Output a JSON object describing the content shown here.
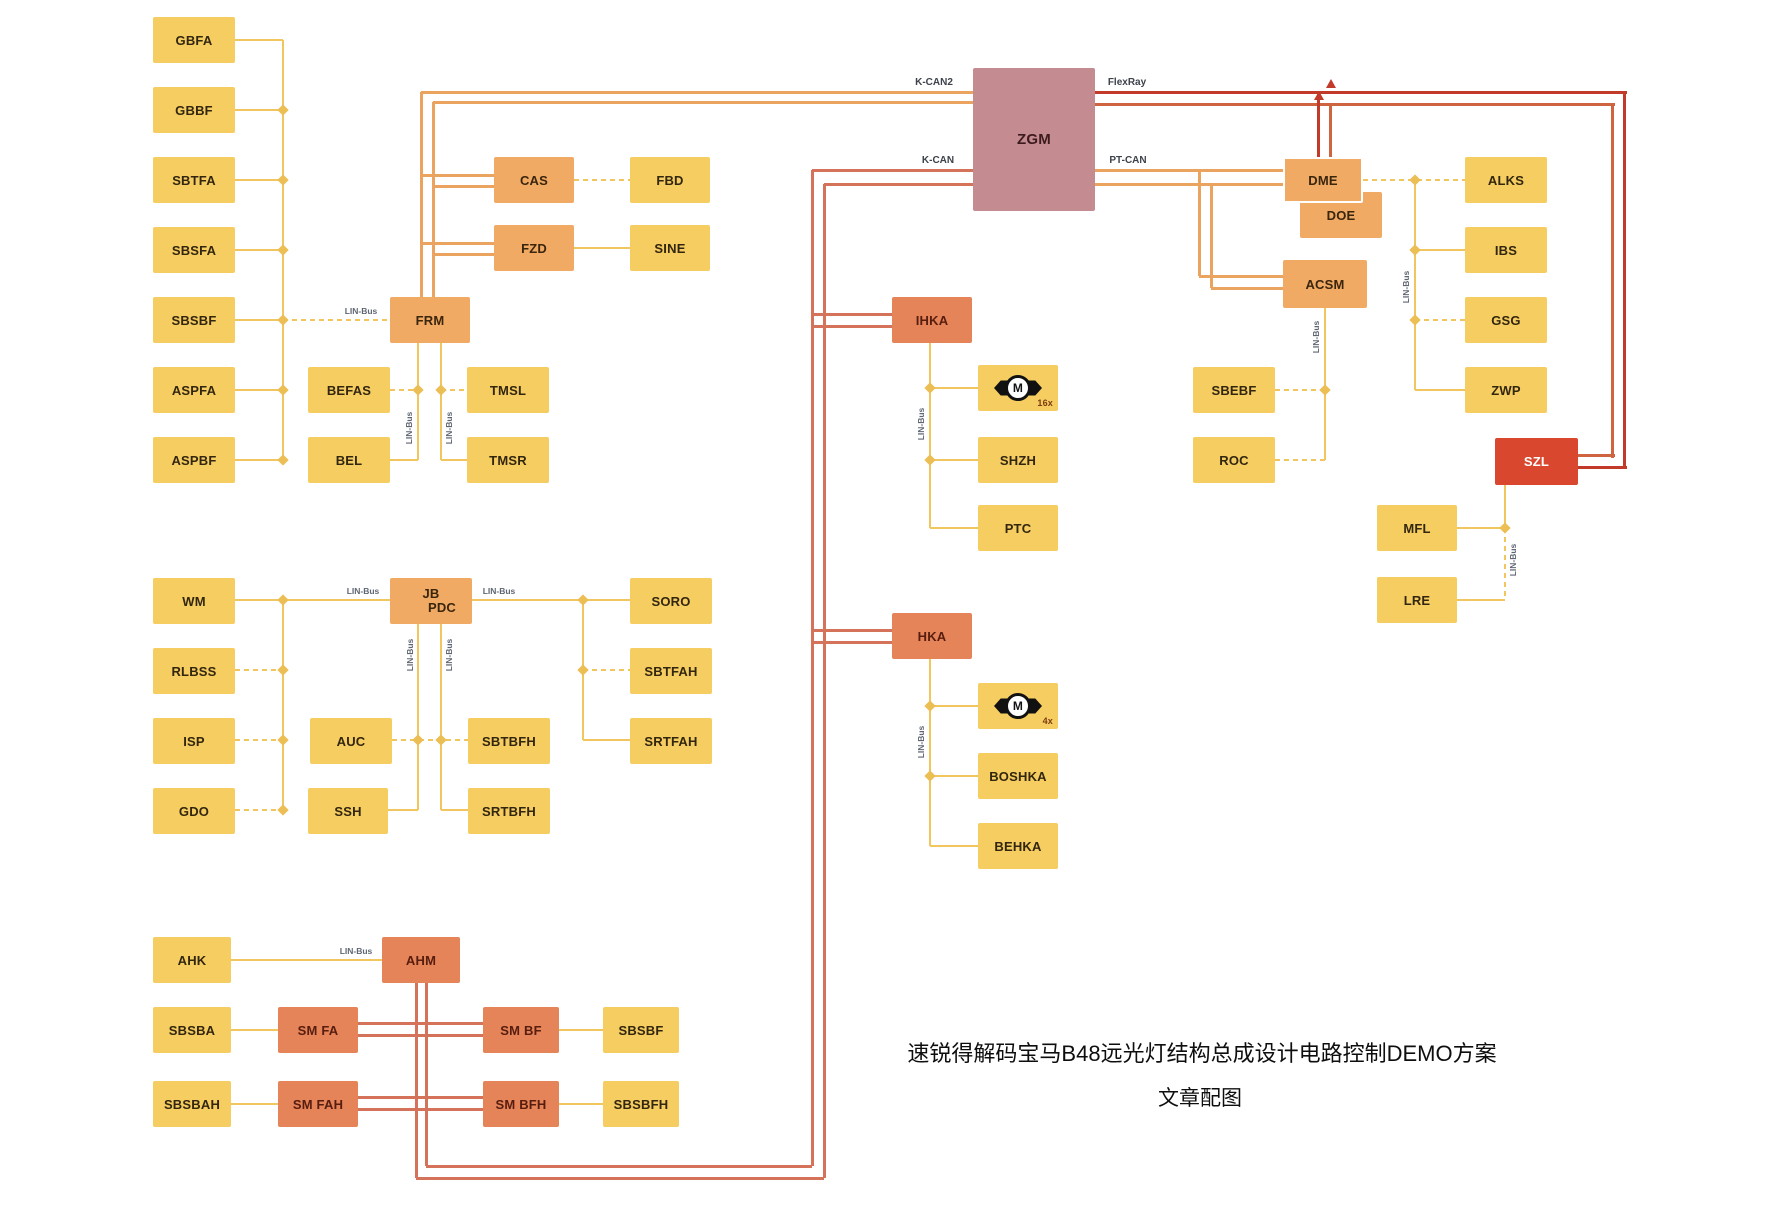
{
  "canvas": {
    "width": 1772,
    "height": 1208,
    "background": "#ffffff"
  },
  "colors": {
    "Y": "#f1c65f",
    "O": "#eba45f",
    "S": "#d5735a",
    "R": "#c23a2a",
    "R2": "#cf6440",
    "junction": "#ecbf55",
    "yellow_box": "#f5cd60",
    "orange_box": "#f0aa64",
    "salmon_box": "#e58459",
    "red_box": "#d9472e",
    "mauve_box": "#c48b90"
  },
  "caption": {
    "line1": "速锐得解码宝马B48远光灯结构总成设计电路控制DEMO方案",
    "line2": "文章配图"
  },
  "bus_labels": [
    {
      "text": "K-CAN2",
      "x": 934,
      "y": 88
    },
    {
      "text": "FlexRay",
      "x": 1127,
      "y": 88
    },
    {
      "text": "K-CAN",
      "x": 938,
      "y": 166
    },
    {
      "text": "PT-CAN",
      "x": 1128,
      "y": 166
    }
  ],
  "lin_labels": [
    {
      "text": "LIN-Bus",
      "x": 361,
      "y": 316,
      "rot": 0
    },
    {
      "text": "LIN-Bus",
      "x": 363,
      "y": 596,
      "rot": 0
    },
    {
      "text": "LIN-Bus",
      "x": 499,
      "y": 596,
      "rot": 0
    },
    {
      "text": "LIN-Bus",
      "x": 356,
      "y": 956,
      "rot": 0
    },
    {
      "text": "LIN-Bus",
      "x": 409,
      "y": 428,
      "rot": 1
    },
    {
      "text": "LIN-Bus",
      "x": 449,
      "y": 428,
      "rot": 1
    },
    {
      "text": "LIN-Bus",
      "x": 410,
      "y": 655,
      "rot": 1
    },
    {
      "text": "LIN-Bus",
      "x": 449,
      "y": 655,
      "rot": 1
    },
    {
      "text": "LIN-Bus",
      "x": 921,
      "y": 424,
      "rot": 1
    },
    {
      "text": "LIN-Bus",
      "x": 921,
      "y": 742,
      "rot": 1
    },
    {
      "text": "LIN-Bus",
      "x": 1406,
      "y": 287,
      "rot": 1
    },
    {
      "text": "LIN-Bus",
      "x": 1316,
      "y": 337,
      "rot": 1
    },
    {
      "text": "LIN-Bus",
      "x": 1513,
      "y": 560,
      "rot": 1
    }
  ],
  "nodes": [
    {
      "id": "gbfa",
      "label": "GBFA",
      "x": 153,
      "y": 17,
      "w": 82,
      "h": 46,
      "t": "y"
    },
    {
      "id": "gbbf",
      "label": "GBBF",
      "x": 153,
      "y": 87,
      "w": 82,
      "h": 46,
      "t": "y"
    },
    {
      "id": "sbtfa",
      "label": "SBTFA",
      "x": 153,
      "y": 157,
      "w": 82,
      "h": 46,
      "t": "y"
    },
    {
      "id": "sbsfa",
      "label": "SBSFA",
      "x": 153,
      "y": 227,
      "w": 82,
      "h": 46,
      "t": "y"
    },
    {
      "id": "sbsbf",
      "label": "SBSBF",
      "x": 153,
      "y": 297,
      "w": 82,
      "h": 46,
      "t": "y"
    },
    {
      "id": "aspfa",
      "label": "ASPFA",
      "x": 153,
      "y": 367,
      "w": 82,
      "h": 46,
      "t": "y"
    },
    {
      "id": "aspbf",
      "label": "ASPBF",
      "x": 153,
      "y": 437,
      "w": 82,
      "h": 46,
      "t": "y"
    },
    {
      "id": "frm",
      "label": "FRM",
      "x": 390,
      "y": 297,
      "w": 80,
      "h": 46,
      "t": "o"
    },
    {
      "id": "cas",
      "label": "CAS",
      "x": 494,
      "y": 157,
      "w": 80,
      "h": 46,
      "t": "o"
    },
    {
      "id": "fzd",
      "label": "FZD",
      "x": 494,
      "y": 225,
      "w": 80,
      "h": 46,
      "t": "o"
    },
    {
      "id": "fbd",
      "label": "FBD",
      "x": 630,
      "y": 157,
      "w": 80,
      "h": 46,
      "t": "y"
    },
    {
      "id": "sine",
      "label": "SINE",
      "x": 630,
      "y": 225,
      "w": 80,
      "h": 46,
      "t": "y"
    },
    {
      "id": "befas",
      "label": "BEFAS",
      "x": 308,
      "y": 367,
      "w": 82,
      "h": 46,
      "t": "y"
    },
    {
      "id": "bel",
      "label": "BEL",
      "x": 308,
      "y": 437,
      "w": 82,
      "h": 46,
      "t": "y"
    },
    {
      "id": "tmsl",
      "label": "TMSL",
      "x": 467,
      "y": 367,
      "w": 82,
      "h": 46,
      "t": "y"
    },
    {
      "id": "tmsr",
      "label": "TMSR",
      "x": 467,
      "y": 437,
      "w": 82,
      "h": 46,
      "t": "y"
    },
    {
      "id": "wm",
      "label": "WM",
      "x": 153,
      "y": 578,
      "w": 82,
      "h": 46,
      "t": "y"
    },
    {
      "id": "rlbss",
      "label": "RLBSS",
      "x": 153,
      "y": 648,
      "w": 82,
      "h": 46,
      "t": "y"
    },
    {
      "id": "isp",
      "label": "ISP",
      "x": 153,
      "y": 718,
      "w": 82,
      "h": 46,
      "t": "y"
    },
    {
      "id": "gdo",
      "label": "GDO",
      "x": 153,
      "y": 788,
      "w": 82,
      "h": 46,
      "t": "y"
    },
    {
      "id": "jb-pdc",
      "lines": [
        "JB",
        "PDC"
      ],
      "x": 390,
      "y": 578,
      "w": 82,
      "h": 46,
      "t": "o"
    },
    {
      "id": "auc",
      "label": "AUC",
      "x": 310,
      "y": 718,
      "w": 82,
      "h": 46,
      "t": "y"
    },
    {
      "id": "ssh",
      "label": "SSH",
      "x": 308,
      "y": 788,
      "w": 80,
      "h": 46,
      "t": "y"
    },
    {
      "id": "sbtbfh",
      "label": "SBTBFH",
      "x": 468,
      "y": 718,
      "w": 82,
      "h": 46,
      "t": "y"
    },
    {
      "id": "srtbfh",
      "label": "SRTBFH",
      "x": 468,
      "y": 788,
      "w": 82,
      "h": 46,
      "t": "y"
    },
    {
      "id": "soro",
      "label": "SORO",
      "x": 630,
      "y": 578,
      "w": 82,
      "h": 46,
      "t": "y"
    },
    {
      "id": "sbtfah",
      "label": "SBTFAH",
      "x": 630,
      "y": 648,
      "w": 82,
      "h": 46,
      "t": "y"
    },
    {
      "id": "srtfah",
      "label": "SRTFAH",
      "x": 630,
      "y": 718,
      "w": 82,
      "h": 46,
      "t": "y"
    },
    {
      "id": "ahk",
      "label": "AHK",
      "x": 153,
      "y": 937,
      "w": 78,
      "h": 46,
      "t": "y"
    },
    {
      "id": "ahm",
      "label": "AHM",
      "x": 382,
      "y": 937,
      "w": 78,
      "h": 46,
      "t": "s"
    },
    {
      "id": "sbsba",
      "label": "SBSBA",
      "x": 153,
      "y": 1007,
      "w": 78,
      "h": 46,
      "t": "y"
    },
    {
      "id": "sm-fa",
      "label": "SM FA",
      "x": 278,
      "y": 1007,
      "w": 80,
      "h": 46,
      "t": "s"
    },
    {
      "id": "sm-bf",
      "label": "SM BF",
      "x": 483,
      "y": 1007,
      "w": 76,
      "h": 46,
      "t": "s"
    },
    {
      "id": "sbsbf-2",
      "label": "SBSBF",
      "x": 603,
      "y": 1007,
      "w": 76,
      "h": 46,
      "t": "y"
    },
    {
      "id": "sbsbah",
      "label": "SBSBAH",
      "x": 153,
      "y": 1081,
      "w": 78,
      "h": 46,
      "t": "y"
    },
    {
      "id": "sm-fah",
      "label": "SM FAH",
      "x": 278,
      "y": 1081,
      "w": 80,
      "h": 46,
      "t": "s"
    },
    {
      "id": "sm-bfh",
      "label": "SM BFH",
      "x": 483,
      "y": 1081,
      "w": 76,
      "h": 46,
      "t": "s"
    },
    {
      "id": "sbsbfh",
      "label": "SBSBFH",
      "x": 603,
      "y": 1081,
      "w": 76,
      "h": 46,
      "t": "y"
    },
    {
      "id": "zgm",
      "label": "ZGM",
      "x": 973,
      "y": 68,
      "w": 122,
      "h": 143,
      "t": "m"
    },
    {
      "id": "ihka",
      "label": "IHKA",
      "x": 892,
      "y": 297,
      "w": 80,
      "h": 46,
      "t": "s"
    },
    {
      "id": "motor-16x",
      "label": "M",
      "sub": "16x",
      "x": 978,
      "y": 365,
      "w": 80,
      "h": 46,
      "t": "y",
      "motor": 1
    },
    {
      "id": "shzh",
      "label": "SHZH",
      "x": 978,
      "y": 437,
      "w": 80,
      "h": 46,
      "t": "y"
    },
    {
      "id": "ptc",
      "label": "PTC",
      "x": 978,
      "y": 505,
      "w": 80,
      "h": 46,
      "t": "y"
    },
    {
      "id": "hka",
      "label": "HKA",
      "x": 892,
      "y": 613,
      "w": 80,
      "h": 46,
      "t": "s"
    },
    {
      "id": "motor-4x",
      "label": "M",
      "sub": "4x",
      "x": 978,
      "y": 683,
      "w": 80,
      "h": 46,
      "t": "y",
      "motor": 1
    },
    {
      "id": "boshka",
      "label": "BOSHKA",
      "x": 978,
      "y": 753,
      "w": 80,
      "h": 46,
      "t": "y"
    },
    {
      "id": "behka",
      "label": "BEHKA",
      "x": 978,
      "y": 823,
      "w": 80,
      "h": 46,
      "t": "y"
    },
    {
      "id": "doe",
      "label": "DOE",
      "x": 1300,
      "y": 192,
      "w": 82,
      "h": 46,
      "t": "o"
    },
    {
      "id": "dme",
      "label": "DME",
      "x": 1283,
      "y": 157,
      "w": 80,
      "h": 46,
      "t": "o",
      "outline": 1
    },
    {
      "id": "acsm",
      "label": "ACSM",
      "x": 1283,
      "y": 260,
      "w": 84,
      "h": 48,
      "t": "o"
    },
    {
      "id": "alks",
      "label": "ALKS",
      "x": 1465,
      "y": 157,
      "w": 82,
      "h": 46,
      "t": "y"
    },
    {
      "id": "ibs",
      "label": "IBS",
      "x": 1465,
      "y": 227,
      "w": 82,
      "h": 46,
      "t": "y"
    },
    {
      "id": "gsg",
      "label": "GSG",
      "x": 1465,
      "y": 297,
      "w": 82,
      "h": 46,
      "t": "y"
    },
    {
      "id": "zwp",
      "label": "ZWP",
      "x": 1465,
      "y": 367,
      "w": 82,
      "h": 46,
      "t": "y"
    },
    {
      "id": "szl",
      "label": "SZL",
      "x": 1495,
      "y": 438,
      "w": 83,
      "h": 47,
      "t": "r"
    },
    {
      "id": "mfl",
      "label": "MFL",
      "x": 1377,
      "y": 505,
      "w": 80,
      "h": 46,
      "t": "y"
    },
    {
      "id": "lre",
      "label": "LRE",
      "x": 1377,
      "y": 577,
      "w": 80,
      "h": 46,
      "t": "y"
    },
    {
      "id": "sbebf",
      "label": "SBEBF",
      "x": 1193,
      "y": 367,
      "w": 82,
      "h": 46,
      "t": "y"
    },
    {
      "id": "roc",
      "label": "ROC",
      "x": 1193,
      "y": 437,
      "w": 82,
      "h": 46,
      "t": "y"
    }
  ],
  "edges": [
    [
      "v",
      283,
      40,
      420,
      "Y",
      "s"
    ],
    [
      "h",
      235,
      40,
      48,
      "Y",
      "s"
    ],
    [
      "h",
      235,
      110,
      48,
      "Y",
      "s"
    ],
    [
      "h",
      235,
      180,
      48,
      "Y",
      "s"
    ],
    [
      "h",
      235,
      250,
      48,
      "Y",
      "s"
    ],
    [
      "h",
      235,
      320,
      48,
      "Y",
      "s"
    ],
    [
      "h",
      283,
      320,
      107,
      "Y",
      "d"
    ],
    [
      "h",
      235,
      390,
      48,
      "Y",
      "s"
    ],
    [
      "h",
      235,
      460,
      48,
      "Y",
      "s"
    ],
    [
      "h",
      421,
      92,
      552,
      "O",
      "s"
    ],
    [
      "h",
      433,
      102,
      540,
      "O",
      "s"
    ],
    [
      "v",
      421,
      92,
      205,
      "O",
      "s"
    ],
    [
      "v",
      433,
      102,
      195,
      "O",
      "s"
    ],
    [
      "h",
      421,
      175,
      73,
      "O",
      "s"
    ],
    [
      "h",
      433,
      186,
      61,
      "O",
      "s"
    ],
    [
      "h",
      421,
      243,
      73,
      "O",
      "s"
    ],
    [
      "h",
      433,
      254,
      61,
      "O",
      "s"
    ],
    [
      "h",
      574,
      180,
      56,
      "Y",
      "d"
    ],
    [
      "h",
      574,
      248,
      56,
      "Y",
      "s"
    ],
    [
      "v",
      418,
      343,
      117,
      "Y",
      "s"
    ],
    [
      "v",
      441,
      343,
      117,
      "Y",
      "s"
    ],
    [
      "h",
      390,
      390,
      28,
      "Y",
      "d"
    ],
    [
      "h",
      441,
      390,
      26,
      "Y",
      "d"
    ],
    [
      "h",
      390,
      460,
      28,
      "Y",
      "s"
    ],
    [
      "h",
      441,
      460,
      26,
      "Y",
      "s"
    ],
    [
      "v",
      283,
      600,
      210,
      "Y",
      "s"
    ],
    [
      "h",
      235,
      600,
      155,
      "Y",
      "s"
    ],
    [
      "h",
      235,
      670,
      48,
      "Y",
      "d"
    ],
    [
      "h",
      235,
      740,
      48,
      "Y",
      "d"
    ],
    [
      "h",
      235,
      810,
      48,
      "Y",
      "d"
    ],
    [
      "h",
      472,
      600,
      158,
      "Y",
      "s"
    ],
    [
      "v",
      583,
      600,
      140,
      "Y",
      "s"
    ],
    [
      "h",
      583,
      670,
      47,
      "Y",
      "d"
    ],
    [
      "h",
      583,
      740,
      47,
      "Y",
      "s"
    ],
    [
      "v",
      418,
      623,
      187,
      "Y",
      "s"
    ],
    [
      "v",
      441,
      623,
      187,
      "Y",
      "s"
    ],
    [
      "h",
      392,
      740,
      76,
      "Y",
      "d"
    ],
    [
      "h",
      388,
      810,
      30,
      "Y",
      "s"
    ],
    [
      "h",
      441,
      810,
      27,
      "Y",
      "s"
    ],
    [
      "h",
      231,
      960,
      151,
      "Y",
      "s"
    ],
    [
      "h",
      231,
      1030,
      47,
      "Y",
      "s"
    ],
    [
      "h",
      559,
      1030,
      44,
      "Y",
      "s"
    ],
    [
      "h",
      231,
      1104,
      47,
      "Y",
      "s"
    ],
    [
      "h",
      559,
      1104,
      44,
      "Y",
      "s"
    ],
    [
      "h",
      358,
      1023,
      125,
      "S",
      "s"
    ],
    [
      "h",
      358,
      1035,
      125,
      "S",
      "s"
    ],
    [
      "h",
      358,
      1097,
      125,
      "S",
      "s"
    ],
    [
      "h",
      358,
      1109,
      125,
      "S",
      "s"
    ],
    [
      "v",
      416,
      983,
      195,
      "S",
      "s"
    ],
    [
      "v",
      426,
      983,
      183,
      "S",
      "s"
    ],
    [
      "h",
      426,
      1166,
      386,
      "S",
      "s"
    ],
    [
      "h",
      416,
      1178,
      408,
      "S",
      "s"
    ],
    [
      "v",
      812,
      170,
      996,
      "S",
      "s"
    ],
    [
      "v",
      824,
      184,
      994,
      "S",
      "s"
    ],
    [
      "h",
      812,
      170,
      161,
      "S",
      "s"
    ],
    [
      "h",
      824,
      184,
      149,
      "S",
      "s"
    ],
    [
      "h",
      812,
      314,
      80,
      "S",
      "s"
    ],
    [
      "h",
      812,
      326,
      80,
      "S",
      "s"
    ],
    [
      "h",
      812,
      630,
      80,
      "S",
      "s"
    ],
    [
      "h",
      812,
      642,
      80,
      "S",
      "s"
    ],
    [
      "v",
      930,
      343,
      185,
      "Y",
      "s"
    ],
    [
      "h",
      930,
      388,
      48,
      "Y",
      "s"
    ],
    [
      "h",
      930,
      460,
      48,
      "Y",
      "s"
    ],
    [
      "h",
      930,
      528,
      48,
      "Y",
      "s"
    ],
    [
      "v",
      930,
      659,
      187,
      "Y",
      "s"
    ],
    [
      "h",
      930,
      706,
      48,
      "Y",
      "s"
    ],
    [
      "h",
      930,
      776,
      48,
      "Y",
      "s"
    ],
    [
      "h",
      930,
      846,
      48,
      "Y",
      "s"
    ],
    [
      "h",
      1095,
      92,
      532,
      "R",
      "s"
    ],
    [
      "h",
      1095,
      104,
      520,
      "R2",
      "s"
    ],
    [
      "v",
      1624,
      92,
      375,
      "R",
      "s"
    ],
    [
      "v",
      1612,
      104,
      354,
      "R2",
      "s"
    ],
    [
      "h",
      1578,
      455,
      37,
      "R2",
      "s"
    ],
    [
      "h",
      1578,
      467,
      49,
      "R",
      "s"
    ],
    [
      "v",
      1318,
      92,
      65,
      "R",
      "s"
    ],
    [
      "v",
      1330,
      104,
      53,
      "R2",
      "s"
    ],
    [
      "h",
      1095,
      170,
      188,
      "O",
      "s"
    ],
    [
      "h",
      1095,
      184,
      188,
      "O",
      "s"
    ],
    [
      "v",
      1199,
      170,
      106,
      "O",
      "s"
    ],
    [
      "v",
      1211,
      184,
      104,
      "O",
      "s"
    ],
    [
      "h",
      1199,
      276,
      84,
      "O",
      "s"
    ],
    [
      "h",
      1211,
      288,
      72,
      "O",
      "s"
    ],
    [
      "h",
      1363,
      180,
      102,
      "Y",
      "d"
    ],
    [
      "v",
      1415,
      180,
      210,
      "Y",
      "s"
    ],
    [
      "h",
      1415,
      250,
      50,
      "Y",
      "s"
    ],
    [
      "h",
      1415,
      320,
      50,
      "Y",
      "d"
    ],
    [
      "h",
      1415,
      390,
      50,
      "Y",
      "s"
    ],
    [
      "v",
      1325,
      308,
      152,
      "Y",
      "s"
    ],
    [
      "h",
      1275,
      390,
      50,
      "Y",
      "d"
    ],
    [
      "h",
      1275,
      460,
      50,
      "Y",
      "d"
    ],
    [
      "v",
      1505,
      485,
      43,
      "Y",
      "s"
    ],
    [
      "v",
      1505,
      528,
      72,
      "Y",
      "d"
    ],
    [
      "h",
      1457,
      528,
      48,
      "Y",
      "s"
    ],
    [
      "h",
      1457,
      600,
      48,
      "Y",
      "s"
    ]
  ],
  "junctions": [
    [
      283,
      110
    ],
    [
      283,
      180
    ],
    [
      283,
      250
    ],
    [
      283,
      320
    ],
    [
      283,
      390
    ],
    [
      283,
      460
    ],
    [
      283,
      600
    ],
    [
      283,
      670
    ],
    [
      283,
      740
    ],
    [
      283,
      810
    ],
    [
      418,
      390
    ],
    [
      441,
      390
    ],
    [
      583,
      600
    ],
    [
      583,
      670
    ],
    [
      418,
      740
    ],
    [
      441,
      740
    ],
    [
      930,
      388
    ],
    [
      930,
      460
    ],
    [
      930,
      706
    ],
    [
      930,
      776
    ],
    [
      1415,
      180
    ],
    [
      1415,
      250
    ],
    [
      1415,
      320
    ],
    [
      1325,
      390
    ],
    [
      1505,
      528
    ]
  ],
  "arrows": [
    [
      1319,
      95
    ],
    [
      1331,
      83
    ]
  ]
}
